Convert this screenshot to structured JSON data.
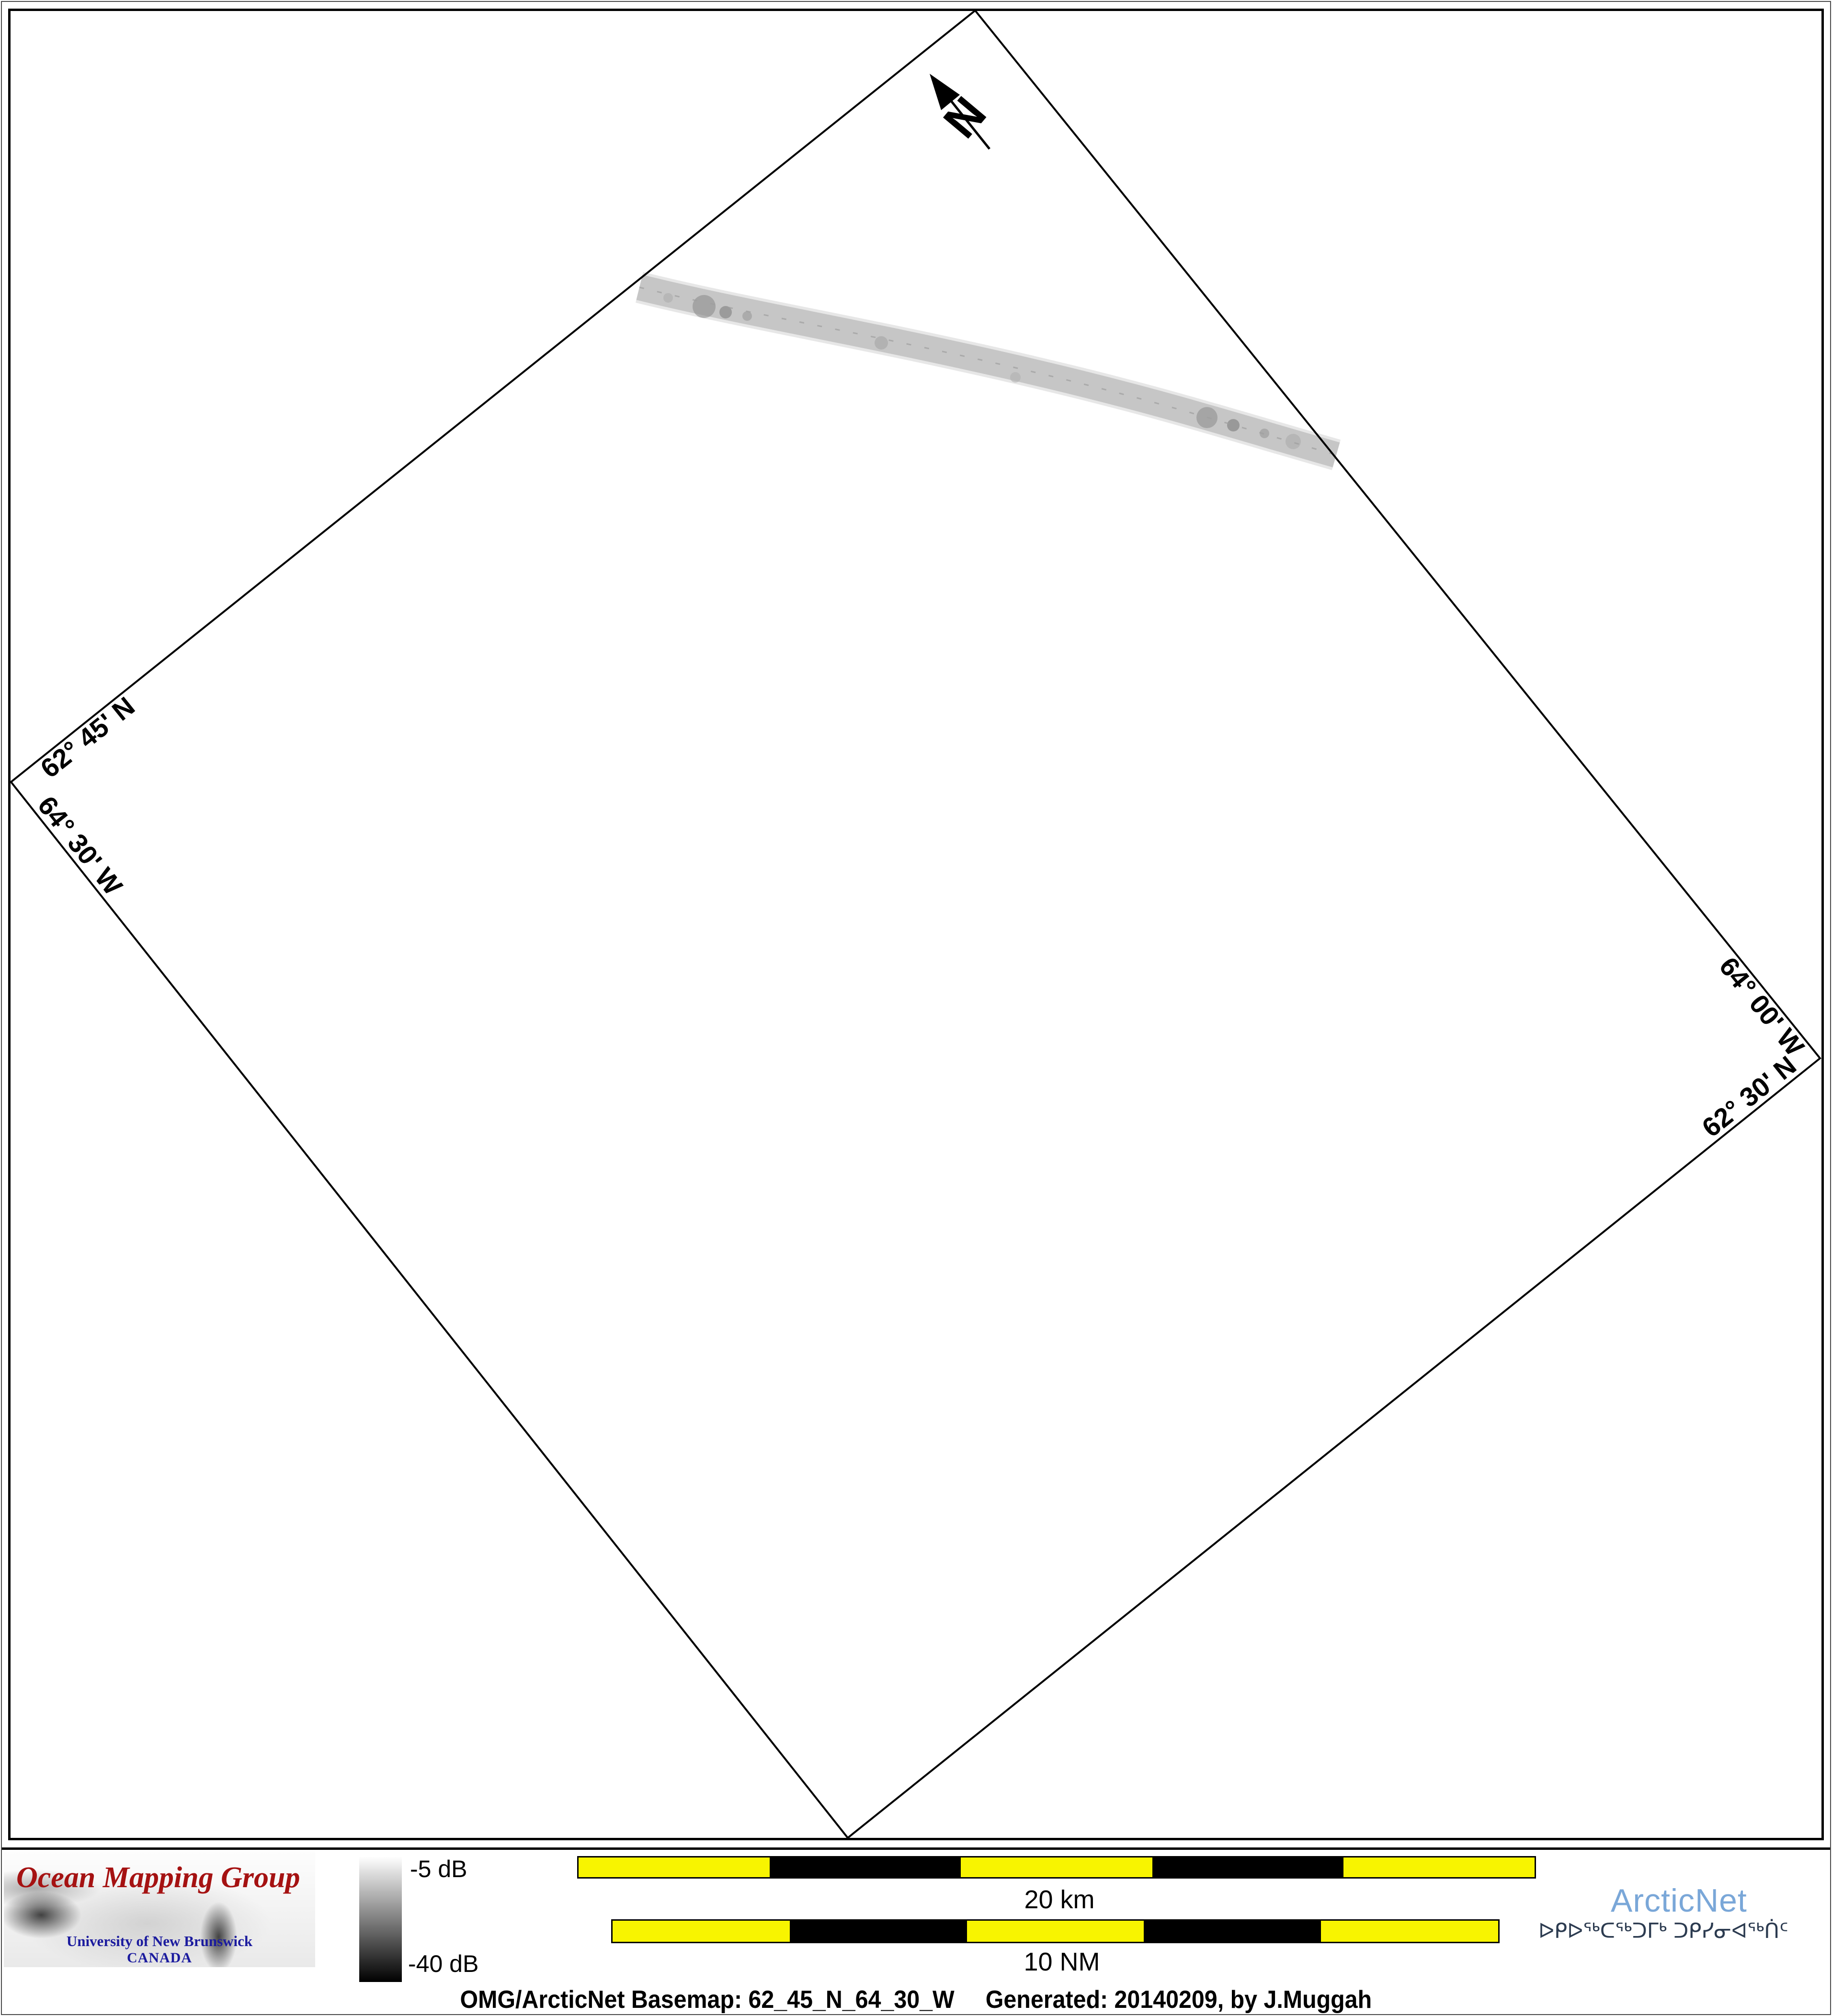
{
  "map": {
    "north_label": "N",
    "edge_labels": {
      "upper_left_lat": "62° 45' N",
      "lower_left_lon": "64° 30' W",
      "upper_right_lon": "64° 00' W",
      "lower_right_lat": "62° 30' N"
    }
  },
  "footer": {
    "omg": {
      "title": "Ocean Mapping Group",
      "university": "University of New Brunswick",
      "country": "CANADA",
      "title_color": "#a51212",
      "text_color": "#1b1b9e"
    },
    "colorbar": {
      "top_label": "-5 dB",
      "bottom_label": "-40 dB",
      "top_color": "#ffffff",
      "bottom_color": "#000000"
    },
    "scalebars": {
      "yellow": "#f8f400",
      "black": "#000000",
      "km": {
        "label": "20 km",
        "pattern": [
          "yellow",
          "black",
          "yellow",
          "black",
          "yellow"
        ]
      },
      "nm": {
        "label": "10 NM",
        "pattern": [
          "yellow",
          "black",
          "yellow",
          "black",
          "yellow"
        ]
      }
    },
    "arcticnet": {
      "wordmark": "ArcticNet",
      "wordmark_color": "#7aa7d8",
      "inuktitut": "ᐅᑭᐅᖅᑕᖅᑐᒥᒃ ᑐᑭᓯᓂᐊᖅᑏᑦ",
      "inuktitut_color": "#2c3b50"
    },
    "caption": {
      "basemap": "OMG/ArcticNet Basemap: 62_45_N_64_30_W",
      "generated": "Generated: 20140209, by J.Muggah"
    }
  }
}
